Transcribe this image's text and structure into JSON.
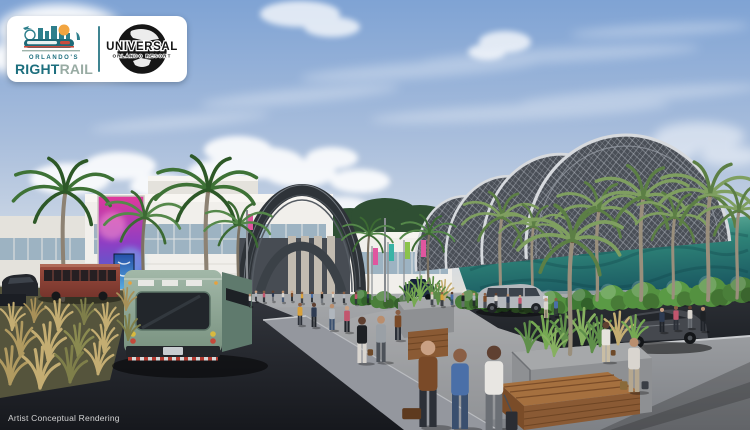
{
  "logo_card": {
    "rightrail": {
      "eyebrow": "ORLANDO'S",
      "word_bold": "RIGHT",
      "word_light": "RAIL"
    },
    "universal": {
      "line1": "UNIVERSAL",
      "line2": "ORLANDO RESORT"
    }
  },
  "caption": {
    "text": "Artist Conceptual Rendering"
  },
  "colors": {
    "sky_top": "#7fa3d4",
    "sky_mid": "#a9bedc",
    "sky_horizon": "#e8e2d6",
    "cloud_white": "#ffffff",
    "building_white": "#f1efeb",
    "glass_blue": "#9db3c2",
    "mural_pink": "#e0399b",
    "mural_purple": "#8e3ec4",
    "mural_blue": "#3b6fd0",
    "arch_steel": "#2e3338",
    "canopy_steel": "#4a4f57",
    "canopy_rib": "#d7dade",
    "wall_teal_light": "#7cc3ab",
    "wall_teal_dark": "#17525e",
    "palm_green": "#3e7236",
    "palm_olive": "#7f9f60",
    "palm_trunk": "#8d8273",
    "bush_green": "#4a7f3a",
    "asphalt_dark": "#1b1d22",
    "plaza_gray": "#97999e",
    "curb_light": "#c9cbce",
    "bus_teal": "#8fa89a",
    "bus_maroon": "#8a3d33",
    "car_silver": "#b4b8bd",
    "car_dark": "#45484e",
    "bench_wood": "#8a5a34",
    "planter_concrete": "#8e9093",
    "brand_teal": "#1d6f7e",
    "brand_green": "#79a83f",
    "brand_rail_gray": "#98aba3",
    "universal_black": "#161616"
  }
}
